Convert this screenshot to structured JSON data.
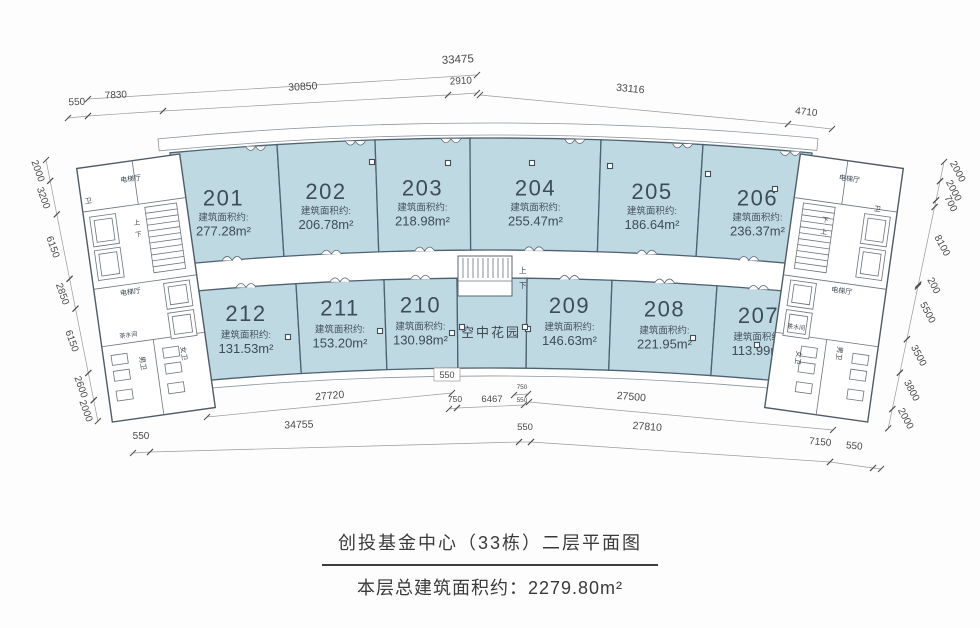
{
  "title": {
    "line1": "创投基金中心（33栋）二层平面图",
    "line2": "本层总建筑面积约：2279.80m²"
  },
  "labels": {
    "area_prefix": "建筑面积约:",
    "garden": "空中花园",
    "elevator_hall": "电梯厅",
    "wc": "卫",
    "men_wc": "男卫",
    "women_wc": "女卫",
    "tea_room": "茶水间",
    "up": "上",
    "down": "下"
  },
  "rooms": {
    "top": [
      {
        "number": "201",
        "area": "277.28m²"
      },
      {
        "number": "202",
        "area": "206.78m²"
      },
      {
        "number": "203",
        "area": "218.98m²"
      },
      {
        "number": "204",
        "area": "255.47m²"
      },
      {
        "number": "205",
        "area": "186.64m²"
      },
      {
        "number": "206",
        "area": "236.37m²"
      }
    ],
    "bottom": [
      {
        "number": "212",
        "area": "131.53m²"
      },
      {
        "number": "211",
        "area": "153.20m²"
      },
      {
        "number": "210",
        "area": "130.98m²"
      },
      {
        "number": "209",
        "area": "146.63m²"
      },
      {
        "number": "208",
        "area": "221.95m²"
      },
      {
        "number": "207",
        "area": "113.99m²"
      }
    ]
  },
  "dimensions": {
    "top_total": "33475",
    "top_left_chain": [
      "550",
      "7830",
      "30850",
      "2910"
    ],
    "top_right_chain": [
      "33116",
      "4710"
    ],
    "left_chain": [
      "2000",
      "3200",
      "6150",
      "2850",
      "6150",
      "2600",
      "2000"
    ],
    "right_chain": [
      "2000",
      "2000",
      "700",
      "8100",
      "200",
      "5500",
      "3500",
      "3800",
      "2000"
    ],
    "bottom_inner": [
      "27720",
      "550",
      "750",
      "6467",
      "750",
      "550",
      "27500"
    ],
    "bottom_outer": [
      "550",
      "34755",
      "550",
      "27810",
      "7150",
      "550"
    ]
  },
  "colors": {
    "room_fill": "#bed9e2",
    "room_stroke": "#4e6170",
    "dim_text": "#4a4a4a",
    "title_text": "#3a3a3a"
  }
}
